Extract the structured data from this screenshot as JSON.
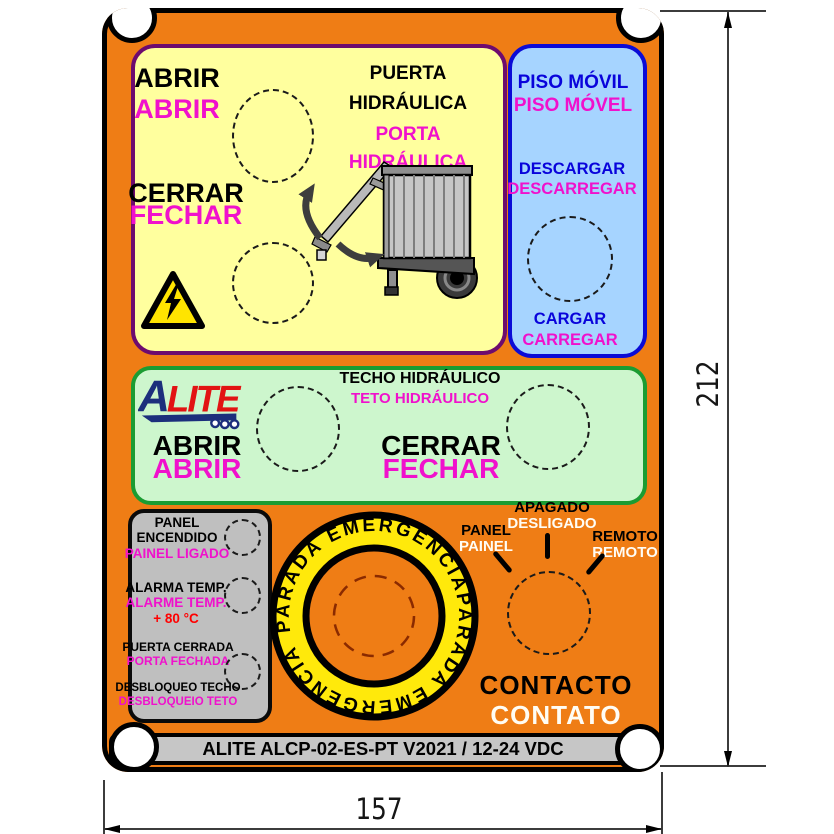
{
  "door": {
    "abrir_es": "ABRIR",
    "abrir_pt": "ABRIR",
    "cerrar_es": "CERRAR",
    "cerrar_pt": "FECHAR",
    "title_es1": "PUERTA",
    "title_es2": "HIDRÁULICA",
    "title_pt1": "PORTA",
    "title_pt2": "HIDRÁULICA"
  },
  "floor": {
    "title_es": "PISO MÓVIL",
    "title_pt": "PISO MÓVEL",
    "descargar_es": "DESCARGAR",
    "descargar_pt": "DESCARREGAR",
    "cargar_es": "CARGAR",
    "cargar_pt": "CARREGAR"
  },
  "roof": {
    "logo_a": "A",
    "logo_rest": "LITE",
    "title_es": "TECHO HIDRÁULICO",
    "title_pt": "TETO HIDRÁULICO",
    "abrir_es": "ABRIR",
    "abrir_pt": "ABRIR",
    "cerrar_es": "CERRAR",
    "cerrar_pt": "FECHAR"
  },
  "status": {
    "row1": {
      "l1": "PANEL",
      "l2": "ENCENDIDO",
      "l3": "PAINEL LIGADO"
    },
    "row2": {
      "l1": "ALARMA TEMP.",
      "l2": "ALARME TEMP.",
      "l3": "+ 80 °C"
    },
    "row3": {
      "l1": "PUERTA CERRADA",
      "l2": "PORTA FECHADA"
    },
    "row4": {
      "l1": "DESBLOQUEO TECHO",
      "l2": "DESBLOQUEIO TETO"
    }
  },
  "emergency": {
    "es": "PARADA EMERGENCIA",
    "pt": "PARADA EMERGÊNCIA"
  },
  "selector": {
    "pos1_es": "PANEL",
    "pos1_pt": "PAINEL",
    "pos2_es": "APAGADO",
    "pos2_pt": "DESLIGADO",
    "pos3_es": "REMOTO",
    "pos3_pt": "REMOTO",
    "contact_es": "CONTACTO",
    "contact_pt": "CONTATO"
  },
  "footer": {
    "label": "ALITE ALCP-02-ES-PT V2021 / 12-24 VDC"
  },
  "dimensions": {
    "height": "212",
    "width": "157"
  },
  "colors": {
    "panel_orange": "#EF7D15",
    "yellow_bg": "#FFFF9E",
    "yellow_border": "#6E0B6E",
    "blue_bg": "#A6D4FF",
    "blue_border": "#0B0BD6",
    "blue_text": "#0903DB",
    "green_bg": "#CDF6CD",
    "green_border": "#1B9C32",
    "gray_bg": "#BFBFBF",
    "magenta_text": "#F011CC",
    "red_text": "#FF0000",
    "ring_yellow": "#FFE90B",
    "warning_yellow": "#FFE400",
    "logo_navy": "#1C2F7C",
    "logo_red": "#E21313"
  }
}
